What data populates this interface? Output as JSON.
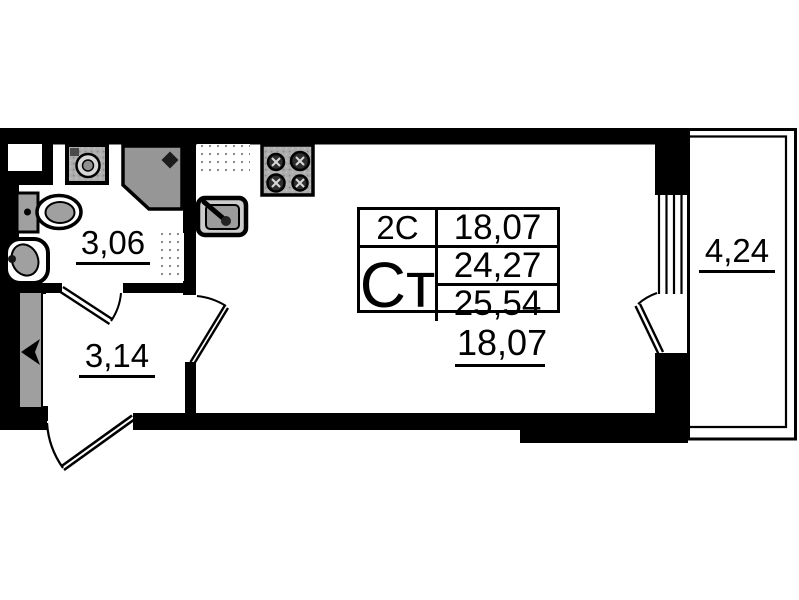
{
  "document": {
    "kind": "apartment floor plan"
  },
  "rooms": {
    "bathroom": {
      "area": "3,06"
    },
    "hallway": {
      "area": "3,14"
    },
    "living_room": {
      "area": "18,07"
    },
    "balcony": {
      "area": "4,24"
    }
  },
  "info_table": {
    "row1_label": "2С",
    "row1_value": "18,07",
    "row2_label": "Ст",
    "row2_value": "24,27",
    "row3_value": "25,54"
  },
  "icons": {
    "fixtures": [
      "washing-machine",
      "shower-cabin",
      "toilet",
      "washbasin",
      "kitchen-sink",
      "stove",
      "entrance-arrow"
    ],
    "symbols": [
      "door-swing-arc",
      "window",
      "balcony-outline"
    ]
  },
  "colors": {
    "walls": "#000000",
    "fixture_gray": "#9d9d9d",
    "background": "#ffffff"
  }
}
